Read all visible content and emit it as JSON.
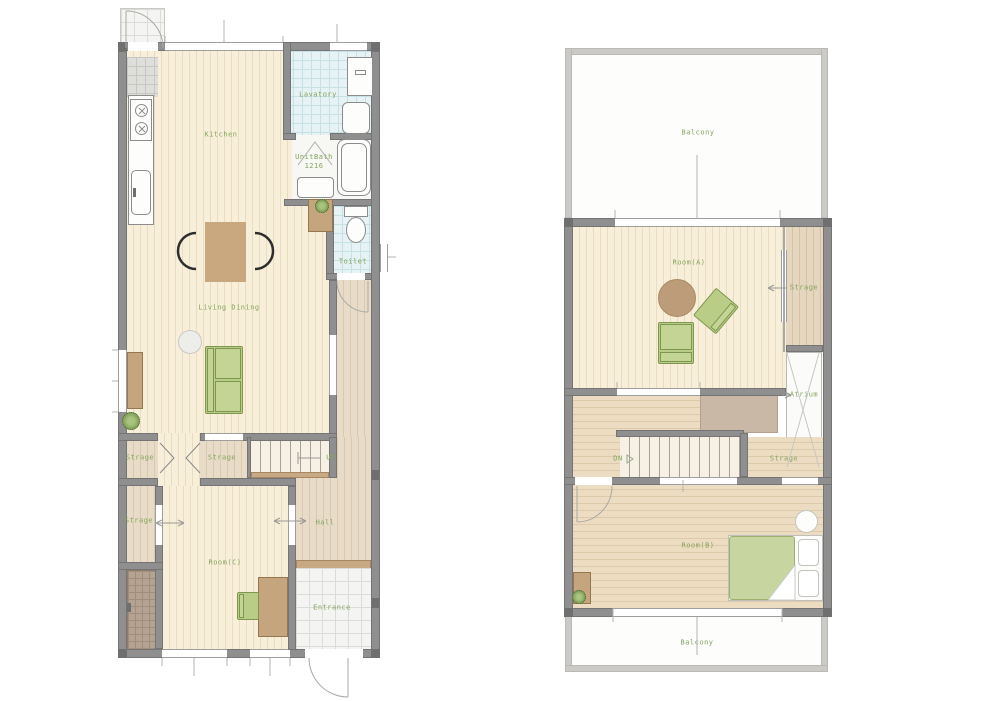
{
  "title": "Two-storey apartment floor plan",
  "floor1": {
    "labels": {
      "kitchen": "Kitchen",
      "lavatory": "Lavatory",
      "unitbath_line1": "UnitBath",
      "unitbath_line2": "1216",
      "toilet": "Toilet",
      "living_dining": "Living Dining",
      "storage_top_left": "Strage",
      "storage_top_right": "Strage",
      "up": "UP",
      "storage_mid_left": "Strage",
      "hall": "Hall",
      "room_c": "Room(C)",
      "entrance": "Entrance"
    }
  },
  "floor2": {
    "labels": {
      "balcony_top": "Balcony",
      "room_a": "Room(A)",
      "storage_right": "Strage",
      "atrium": "Atrium",
      "dn": "DN",
      "storage_mid": "Strage",
      "room_b": "Room(B)",
      "balcony_bottom": "Balcony"
    }
  },
  "colors": {
    "label_text": "#84a45c",
    "wall": "#8f8f8f",
    "balcony_wall": "#cbcac7",
    "wood_floor": "#f8efdb",
    "hall_floor": "#e8dcc8",
    "tile_cyan": "#e6f2f3",
    "entrance_tile": "#f4f4f2",
    "closet_brown": "#b5a391",
    "furniture_brown": "#c9a87f",
    "furniture_green": "#b9cd86",
    "bed_green": "#c7d6a0",
    "step_brown": "#c7a985"
  }
}
